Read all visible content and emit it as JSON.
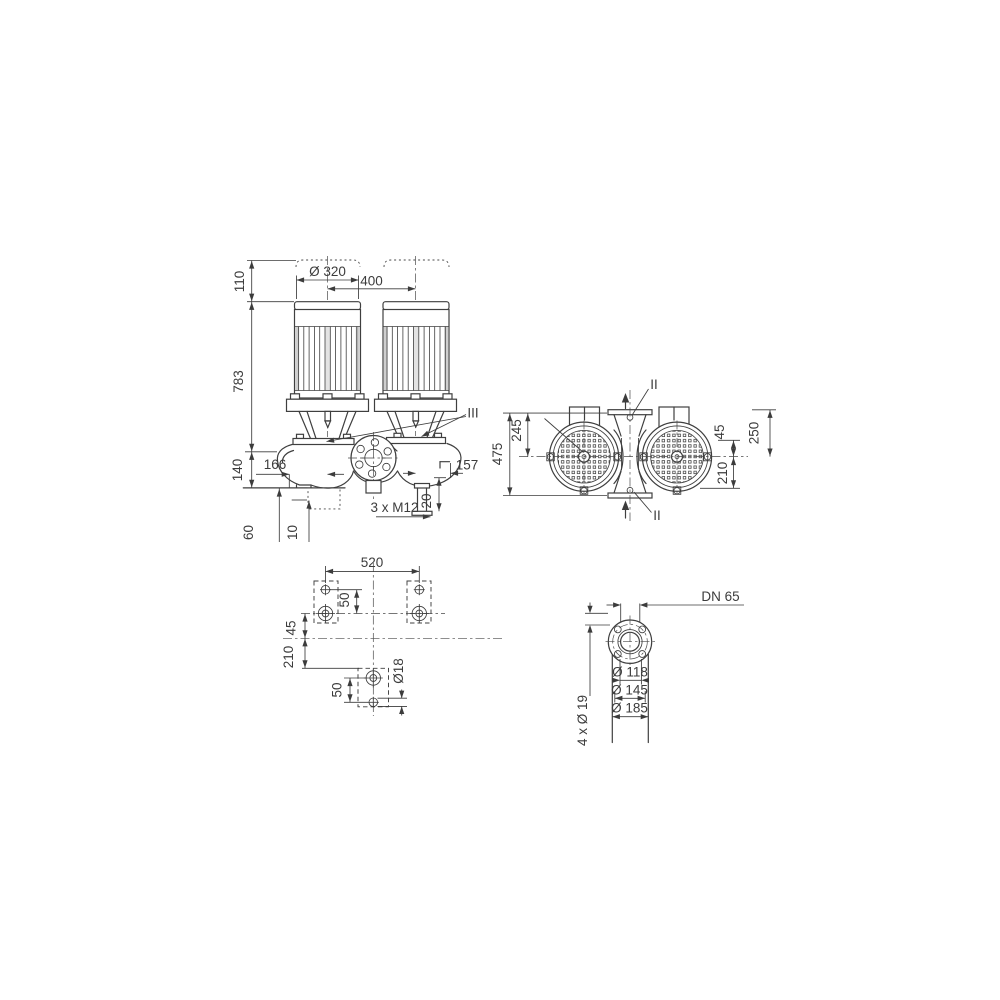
{
  "drawing": {
    "kind": "pump-dimensional-drawing",
    "colors": {
      "line": "#3f3f3f",
      "text": "#3c3c3c",
      "background": "#ffffff"
    },
    "views": {
      "front": {
        "dims": {
          "motor_clearance": "110",
          "motor_diameter": "Ø 320",
          "motor_spacing": "400",
          "total_height": "783",
          "base_to_axis": "140",
          "offset_left": "166",
          "offset_right": "157",
          "foot_offset": "20",
          "anchor_bolts": "3 x M12",
          "pad_height": "60",
          "pad_thickness": "10",
          "detail_label": "III"
        }
      },
      "plan": {
        "dims": {
          "overall_depth": "475",
          "axis_to_top_edge": "245",
          "port_offset": "45",
          "motor_face_to_axis": "250",
          "axis_to_bottom_flange": "210",
          "section_label_top": "II",
          "section_label_bottom": "II"
        }
      },
      "foundation": {
        "dims": {
          "bolt_spacing": "520",
          "hole_pitch_top": "50",
          "axis_offset_a": "45",
          "axis_offset_b": "210",
          "hole_pitch_bottom": "50",
          "hole_diameter": "Ø18"
        }
      },
      "flange": {
        "dims": {
          "nominal_diameter": "DN 65",
          "bolt_circle": "Ø 118",
          "raised_face": "Ø 145",
          "outer_diameter": "Ø 185",
          "bolt_holes": "4 x Ø 19"
        }
      }
    }
  }
}
